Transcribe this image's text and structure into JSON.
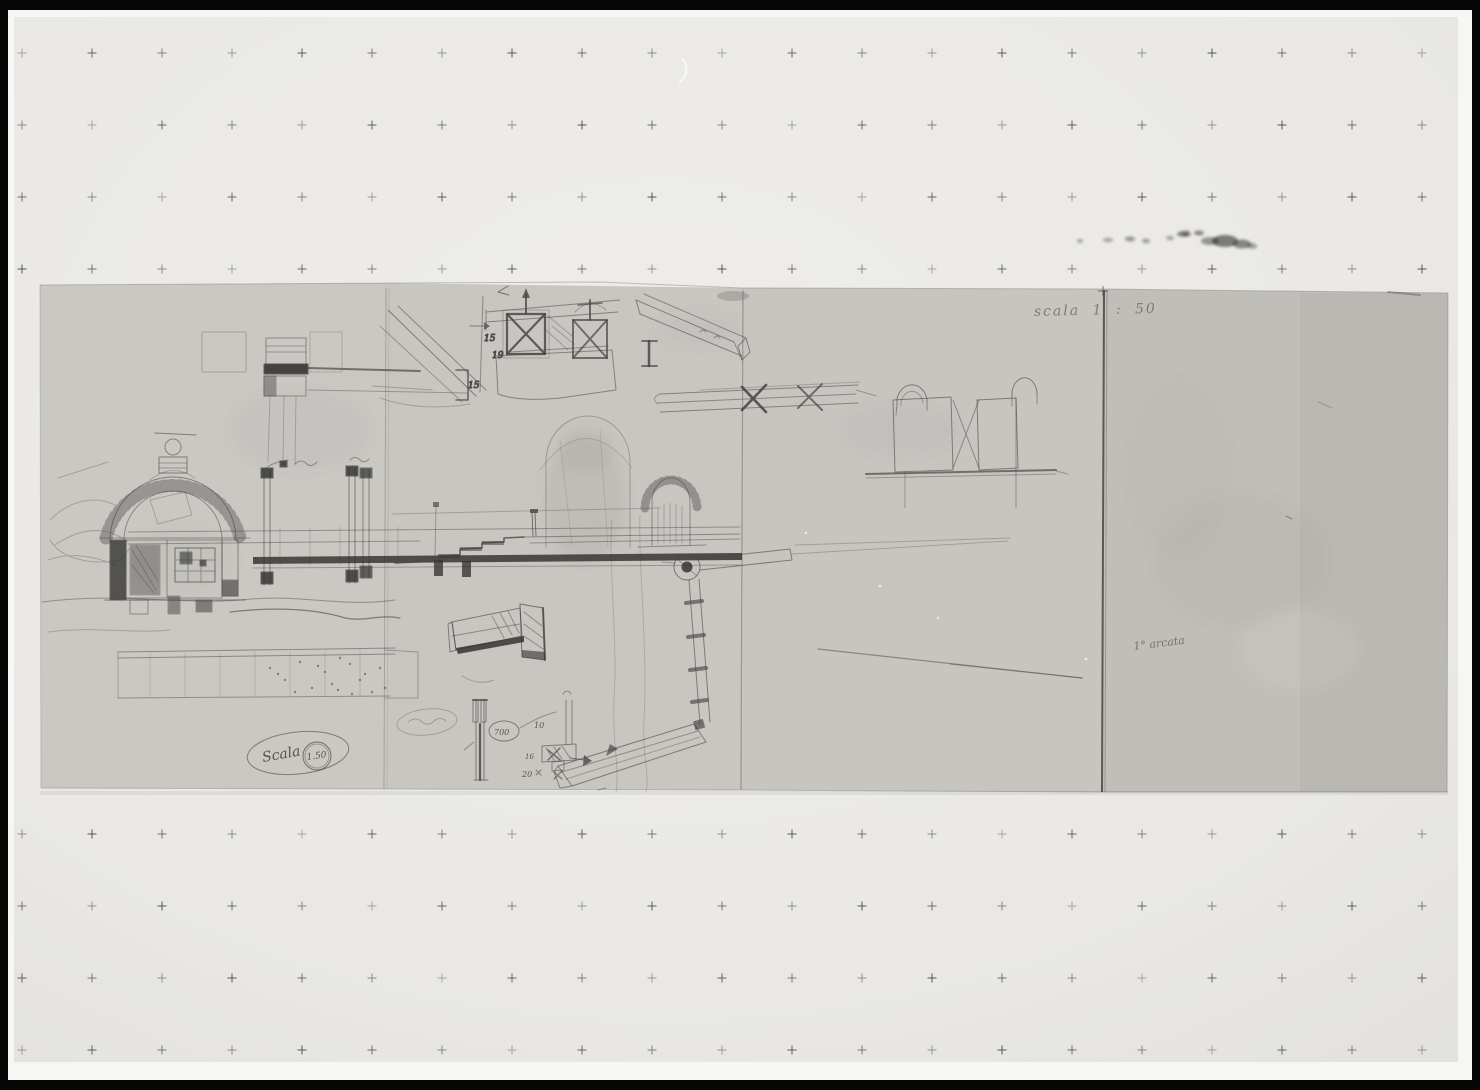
{
  "photo": {
    "annotations": {
      "scale_note_top": "scala  1 : 50",
      "oval_label": "Scala",
      "oval_value": "1.50",
      "panel4_note": "1° arcata",
      "dim_15a": "15",
      "dim_19": "19",
      "dim_15b": "15",
      "dim_700": "700",
      "dim_10": "10",
      "dim_16": "16",
      "dim_20": "20"
    },
    "registration_marks": {
      "col_start": 22,
      "col_spacing": 70,
      "col_count": 21,
      "rows": [
        53,
        125,
        197,
        269,
        834,
        906,
        978,
        1050
      ],
      "size": 9,
      "color": "#3c3c3c"
    },
    "colors": {
      "frame": "#060606",
      "photo_paper": "#f6f6f3",
      "backing_sheet": "#eae9e6",
      "sketch_paper_1": "#cac8c3",
      "sketch_paper_2": "#c8c6c1",
      "sketch_paper_3": "#c7c5c0",
      "sketch_paper_4": "#c0beb8",
      "pencil": "#4a4845"
    }
  }
}
